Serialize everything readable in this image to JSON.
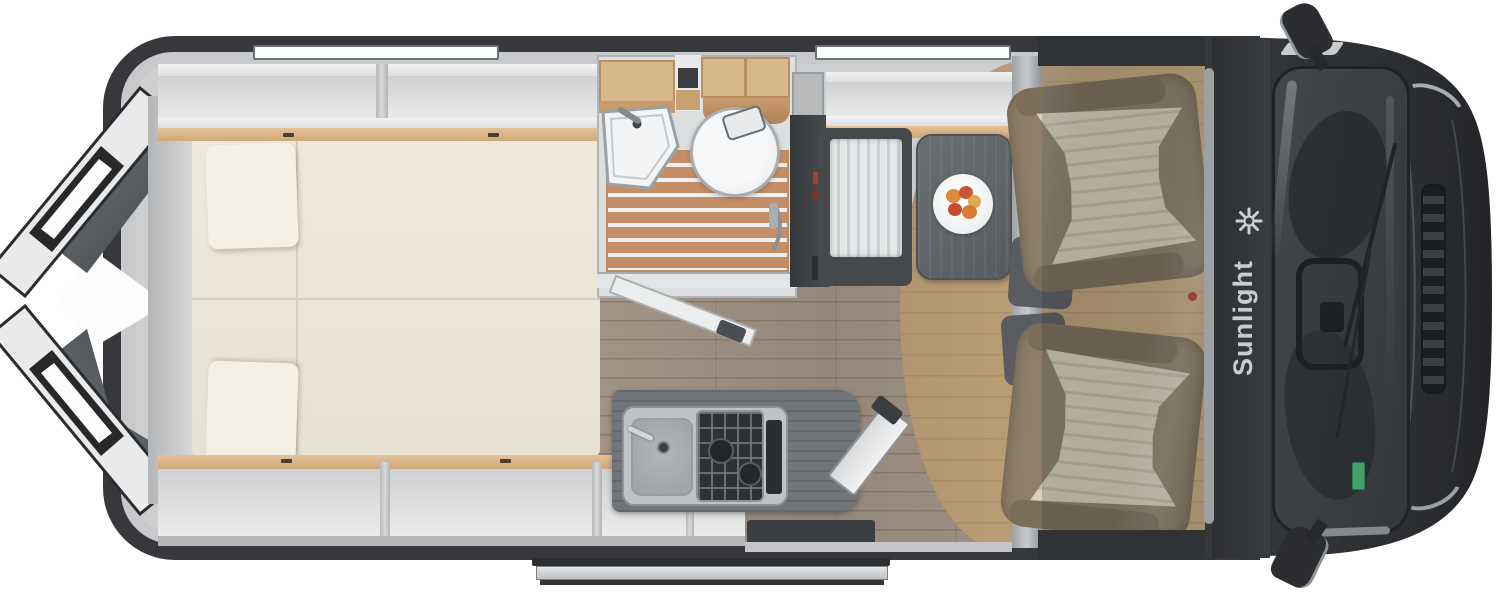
{
  "brand": {
    "logo_text": "Sunlight",
    "logo_icon_name": "eight-spoke-star",
    "logo_icon_glyph": "✳"
  },
  "colors": {
    "body_dark": "#333639",
    "cab_dark": "#2a2c2f",
    "interior_wall": "#c6c8ca",
    "furniture_white": "#eff0f1",
    "wood_trim": "#d9b58a",
    "mattress_cream": "#ece6d8",
    "bathroom_teak": "#c68e67",
    "floor_plank": "#9c8e80",
    "floor_cab_tan": "#b89c77",
    "counter_gray": "#717578",
    "table_gray": "#64696c",
    "seat_beige": "#8f7f6a",
    "seat_pleat": "#d9cfba",
    "accent_red": "#b33a2e",
    "windshield_glass": "#3e4246",
    "sticker_green": "#3fa169",
    "step_silver": "#d9dbdc"
  }
}
